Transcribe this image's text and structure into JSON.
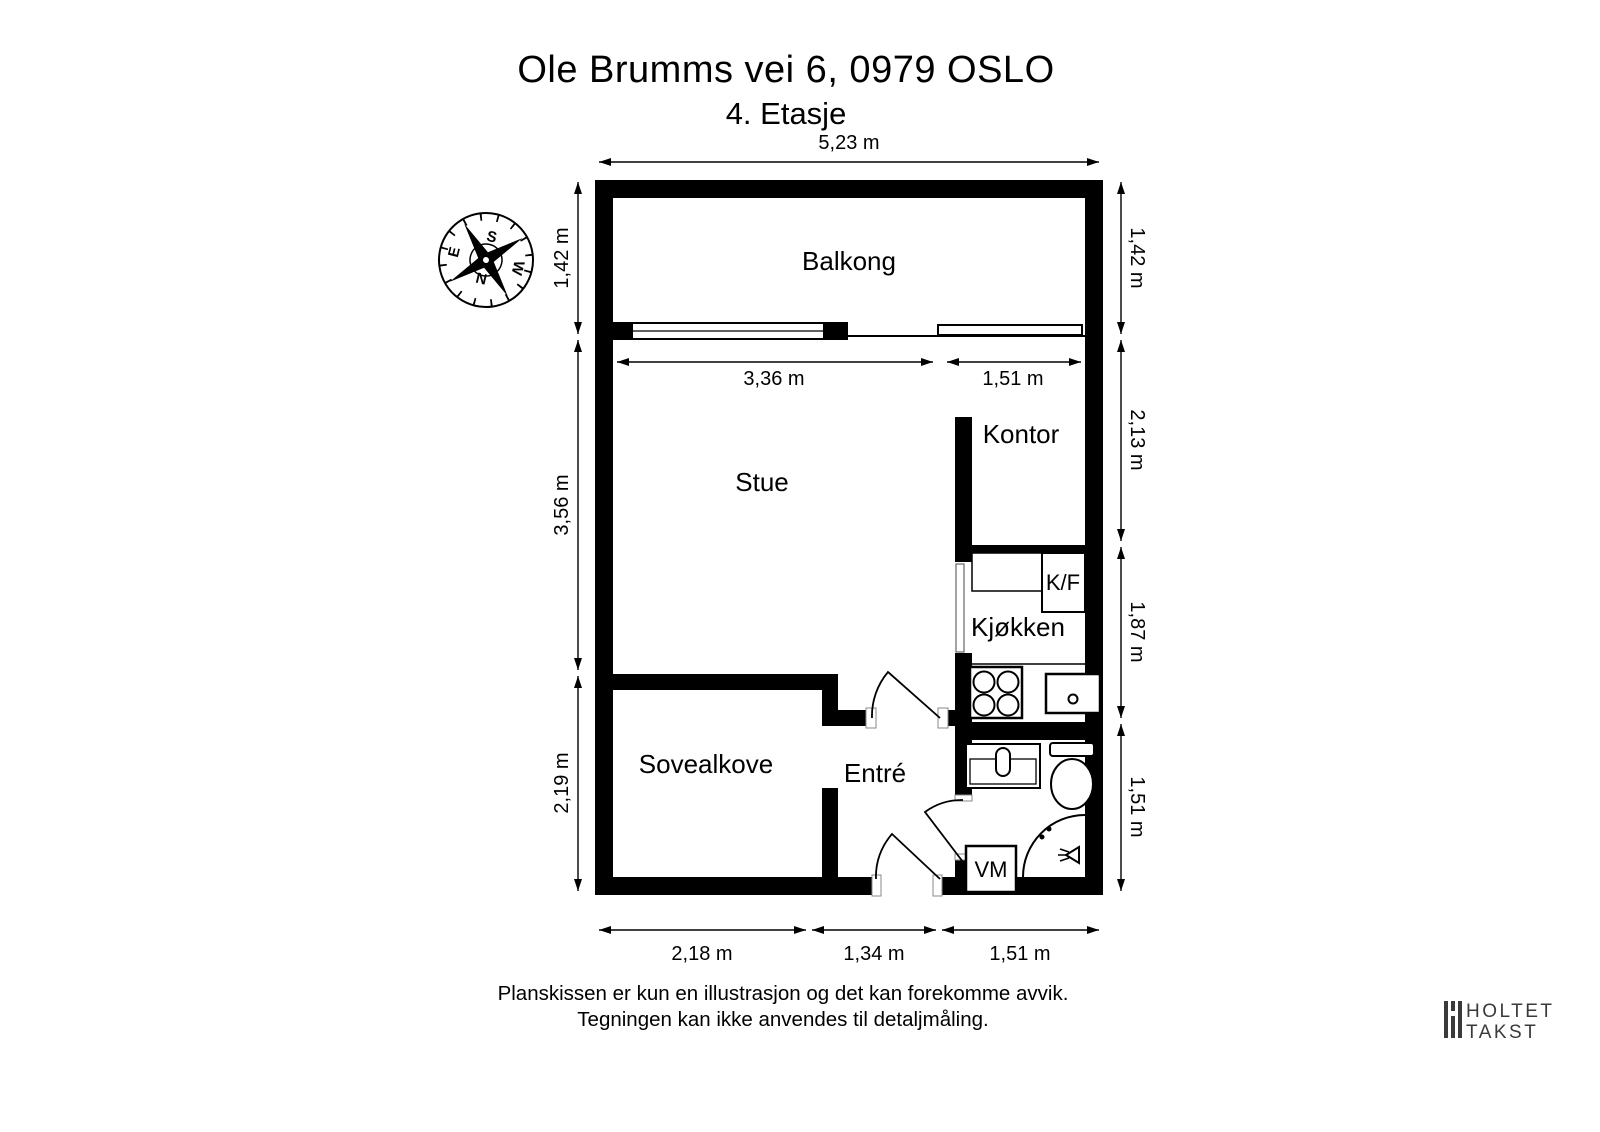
{
  "header": {
    "title": "Ole Brumms vei 6, 0979 OSLO",
    "subtitle": "4. Etasje"
  },
  "plan": {
    "rooms": {
      "balkong": "Balkong",
      "stue": "Stue",
      "kontor": "Kontor",
      "kjokken": "Kjøkken",
      "sovealkove": "Sovealkove",
      "entre": "Entré"
    },
    "fixtures": {
      "fridge_freezer": "K/F",
      "washing_machine": "VM"
    }
  },
  "dimensions": {
    "top": "5,23 m",
    "left": [
      "1,42 m",
      "3,56 m",
      "2,19 m"
    ],
    "right": [
      "1,42 m",
      "2,13 m",
      "1,87 m",
      "1,51 m"
    ],
    "window": [
      "3,36 m",
      "1,51 m"
    ],
    "bottom": [
      "2,18 m",
      "1,34 m",
      "1,51 m"
    ]
  },
  "compass": {
    "north": "N",
    "south": "S",
    "east": "E",
    "west": "W"
  },
  "footer": {
    "line1": "Planskissen er kun en illustrasjon og det kan forekomme avvik.",
    "line2": "Tegningen kan ikke anvendes til detaljmåling."
  },
  "logo": {
    "line1": "HOLTET",
    "line2": "TAKST"
  },
  "colors": {
    "wall": "#000000",
    "background": "#ffffff",
    "logo_text": "#3a3a3a"
  }
}
